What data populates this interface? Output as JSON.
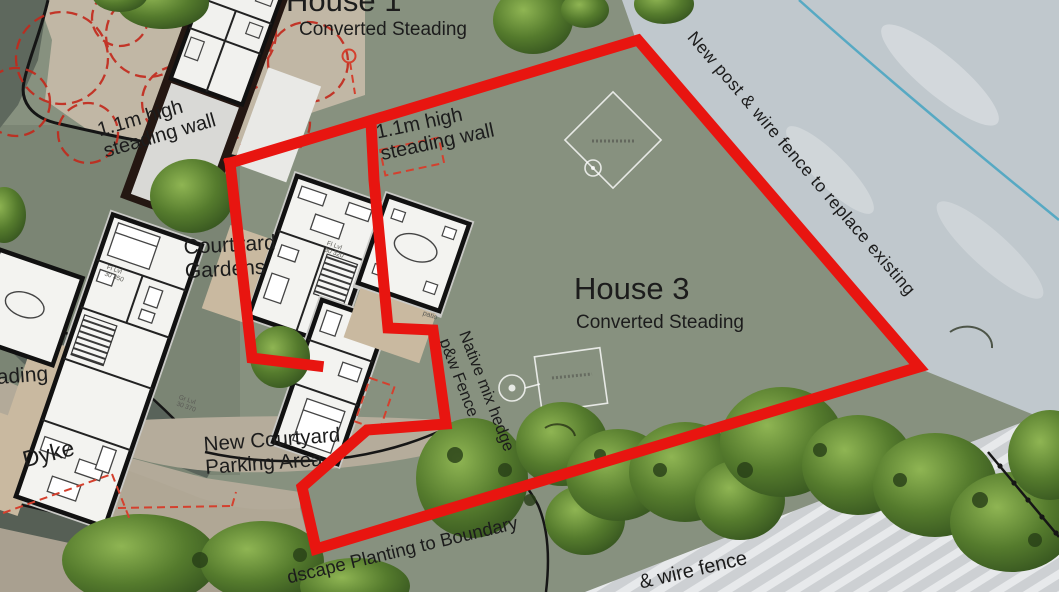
{
  "site_plan": {
    "title_context": "Residential steading conversion site plan",
    "houses": {
      "house1": {
        "name": "House 1",
        "type": "Converted Steading"
      },
      "house3": {
        "name": "House 3",
        "type": "Converted Steading"
      }
    },
    "labels": {
      "house1_title": "House 1",
      "house1_subtitle": "Converted Steading",
      "wall_label_left": "1.1m high\nsteading wall",
      "wall_label_right": "1.1m high\nsteading wall",
      "courtyard_gardens": "Courtyard\nGardens",
      "house3_title": "House 3",
      "house3_subtitle": "Converted Steading",
      "new_post_wire_fence": "New post & wire fence to replace existing",
      "native_hedge": "Native mix hedge\np&w Fence",
      "parking": "New Courtyard\nParking Area",
      "dyke": "Dyke",
      "steading_partial": "ading",
      "landscape_planting": "dscape Planting to Boundary",
      "wire_fence_partial": "& wire fence",
      "patio": "patio",
      "floor_level_central": "Fl Lvl\n30 320",
      "floor_level_left": "Fl Lvl\n30 350",
      "ground_level_left": "Gr Lvl\n30 370"
    },
    "colors": {
      "boundary_red": "#e81510",
      "tree_outline_red": "#c3281b",
      "water_line_blue": "#57a9c3",
      "site_green": "#87917f",
      "gravel_tan": "#c1b7a5",
      "patio_tan": "#c9b9a0",
      "outside_light": "#c0c8cd"
    },
    "symbols": [
      "diamond-survey-marker",
      "square-survey-marker",
      "circle-tree-marker",
      "post-and-wire-fence-line"
    ]
  }
}
